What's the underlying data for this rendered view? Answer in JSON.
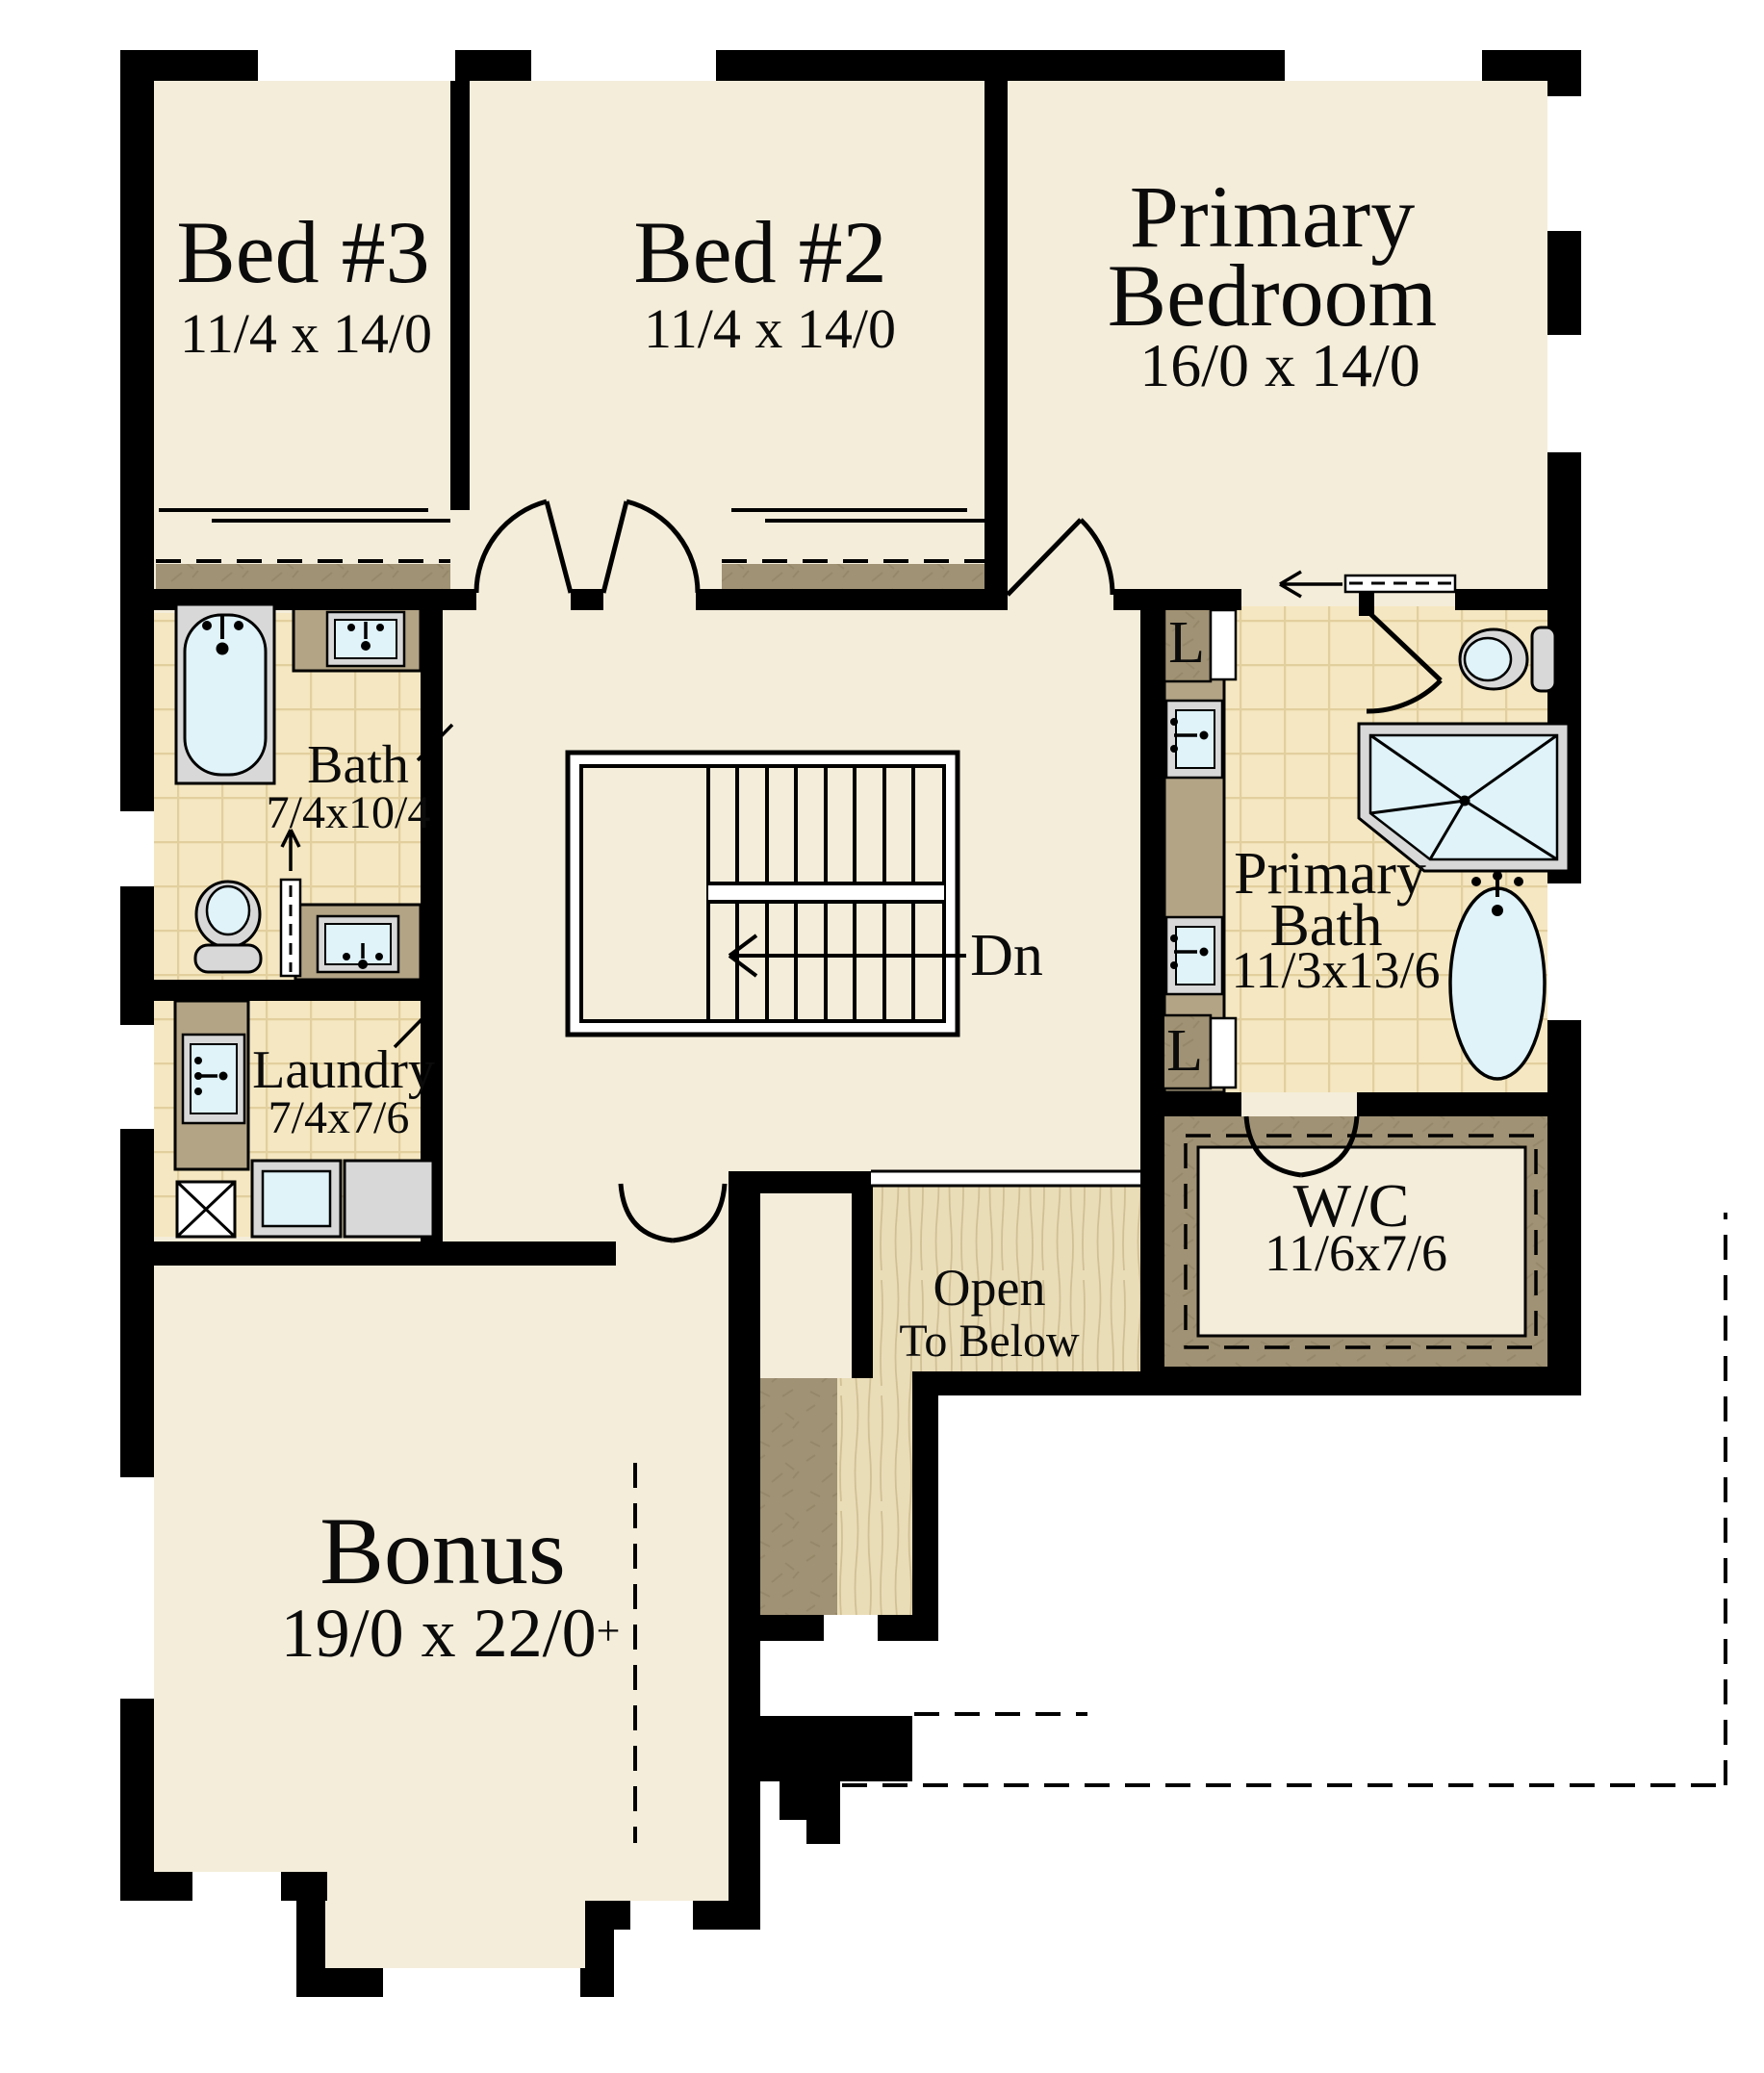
{
  "rooms": {
    "bed3": {
      "name": "Bed #3",
      "dims": "11/4 x 14/0"
    },
    "bed2": {
      "name": "Bed #2",
      "dims": "11/4 x 14/0"
    },
    "primary_bedroom": {
      "name_line1": "Primary",
      "name_line2": "Bedroom",
      "dims": "16/0 x 14/0"
    },
    "bath": {
      "name": "Bath",
      "dims": "7/4x10/4"
    },
    "laundry": {
      "name": "Laundry",
      "dims": "7/4x7/6"
    },
    "primary_bath": {
      "name_line1": "Primary",
      "name_line2": "Bath",
      "dims": "11/3x13/6"
    },
    "wc": {
      "name": "W/C",
      "dims": "11/6x7/6"
    },
    "bonus": {
      "name": "Bonus",
      "dims": "19/0 x 22/0",
      "dims_suffix": "+"
    },
    "open_to_below": {
      "name_line1": "Open",
      "name_line2": "To Below"
    }
  },
  "stairs": {
    "down_label": "Dn"
  },
  "closets": {
    "linen_label": "L"
  },
  "colors": {
    "wall": "#000000",
    "cream": "#f4edda",
    "tile": "#f5e7c1",
    "tileGrid": "#e2cf9e",
    "carpet": "#a09274",
    "counter": "#b2a485",
    "wood": "#e9ddb8",
    "woodGrain": "#d2c095",
    "gray": "#d8d8d8",
    "blue": "#dff3f9"
  }
}
